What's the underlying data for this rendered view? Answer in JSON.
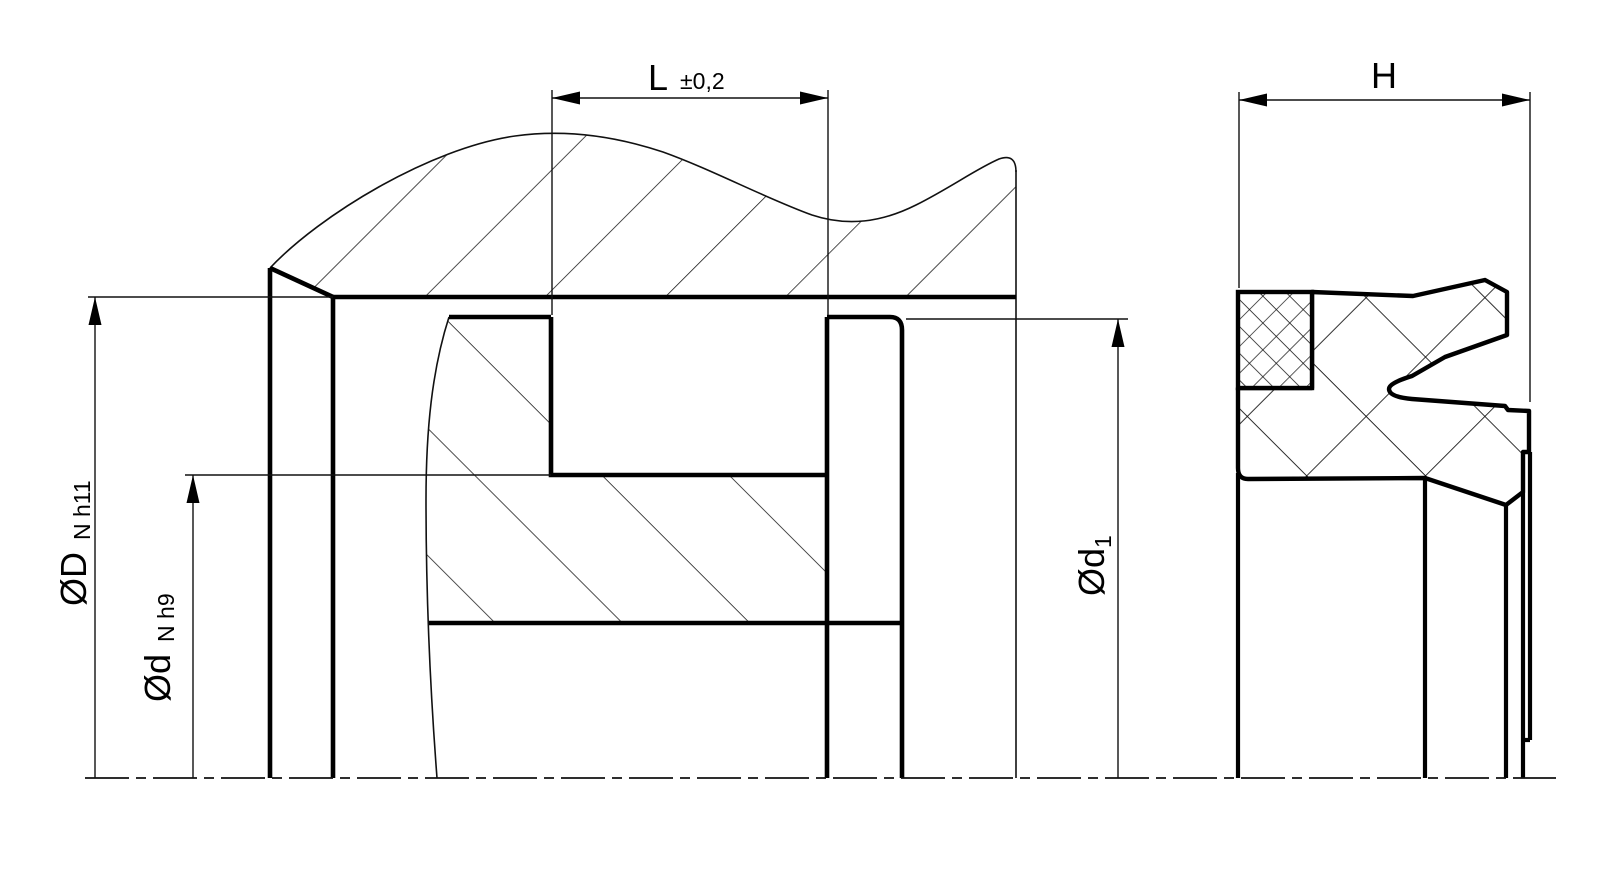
{
  "drawing": {
    "type": "technical-section-drawing",
    "colors": {
      "background": "#ffffff",
      "line": "#000000"
    },
    "left_view": {
      "name": "seal-groove-installation-section",
      "dim_groove_width": {
        "symbol": "L",
        "tolerance": "±0,2"
      },
      "dim_bore_diameter": {
        "symbol": "ØD",
        "tolerance": "N h11"
      },
      "dim_groove_diameter": {
        "symbol": "Ød",
        "tolerance": "N h9"
      },
      "dim_rod_diameter": {
        "symbol": "Ød",
        "subscript": "1"
      }
    },
    "right_view": {
      "name": "seal-cross-section",
      "dim_height": {
        "symbol": "H"
      }
    }
  }
}
